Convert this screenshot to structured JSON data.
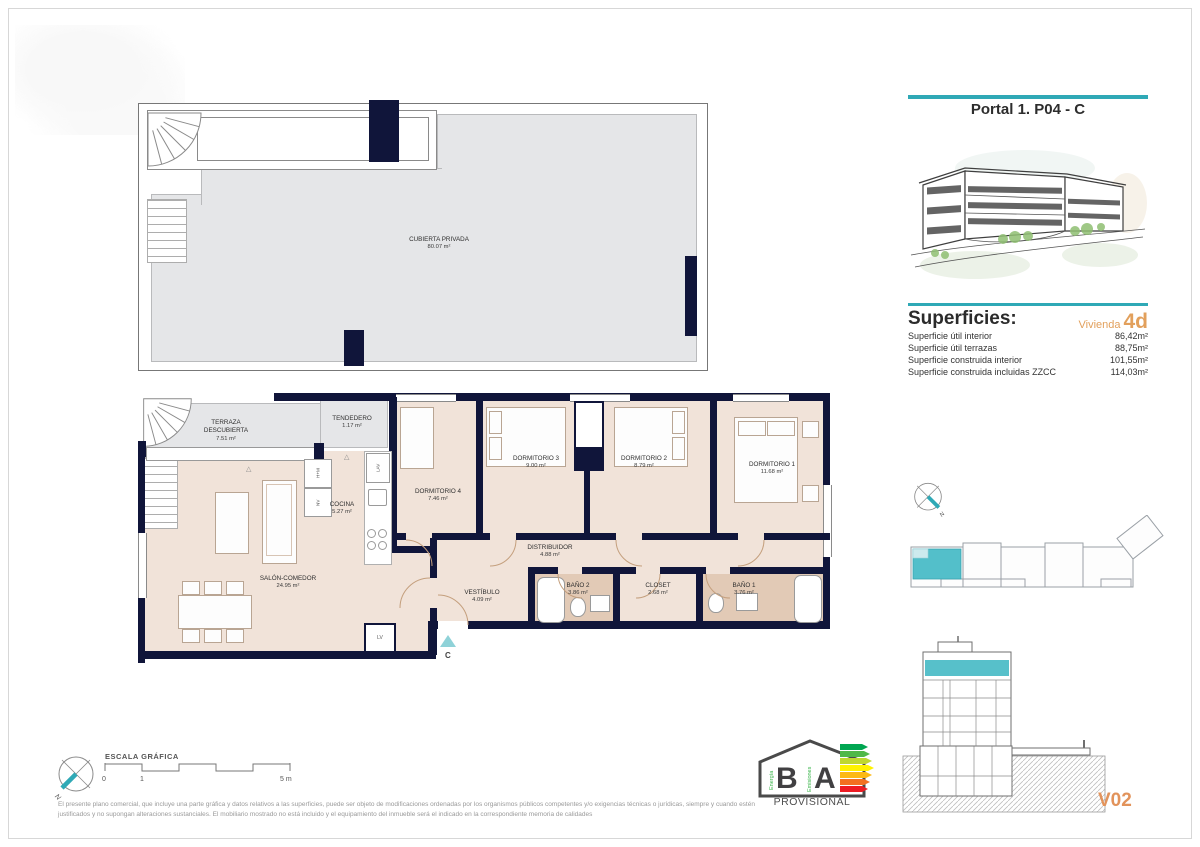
{
  "colors": {
    "teal_accent": "#2FA9B6",
    "teal_highlight": "#53BFCA",
    "orange_accent": "#E2A05C",
    "wall_navy": "#10153A",
    "floor_beige": "#F1E3D9",
    "bath_tan": "#E2CAB6",
    "terrace_gray": "#E5E6E8"
  },
  "header": {
    "title": "Portal 1. P04 - C"
  },
  "superficies": {
    "title": "Superficies:",
    "vivienda_label": "Vivienda",
    "vivienda_code": "4d",
    "rows": [
      {
        "label": "Superficie útil interior",
        "value": "86,42m²"
      },
      {
        "label": "Superficie útil terrazas",
        "value": "88,75m²"
      },
      {
        "label": "Superficie construida interior",
        "value": "101,55m²"
      },
      {
        "label": "Superficie construida incluidas ZZCC",
        "value": "114,03m²"
      }
    ]
  },
  "roof_plan": {
    "name": "CUBIERTA PRIVADA",
    "area": "80.07 m²"
  },
  "floor_plan": {
    "rooms": [
      {
        "name": "TERRAZA\nDESCUBIERTA",
        "area": "7.51 m²"
      },
      {
        "name": "TENDEDERO",
        "area": "1.17 m²"
      },
      {
        "name": "COCINA",
        "area": "5.27 m²"
      },
      {
        "name": "DORMITORIO 4",
        "area": "7.46 m²"
      },
      {
        "name": "DORMITORIO 3",
        "area": "9.00 m²"
      },
      {
        "name": "DORMITORIO 2",
        "area": "8.79 m²"
      },
      {
        "name": "DORMITORIO 1",
        "area": "11.68 m²"
      },
      {
        "name": "DISTRIBUIDOR",
        "area": "4.88 m²"
      },
      {
        "name": "VESTÍBULO",
        "area": "4.09 m²"
      },
      {
        "name": "BAÑO 2",
        "area": "3.86 m²"
      },
      {
        "name": "CLOSET",
        "area": "2.68 m²"
      },
      {
        "name": "BAÑO 1",
        "area": "3.76 m²"
      },
      {
        "name": "SALÓN-COMEDOR",
        "area": "24.95 m²"
      }
    ],
    "appliances": {
      "oven_micro": "H+M",
      "fridge": "NV",
      "washer": "LAV",
      "dishwasher": "LV"
    },
    "entrance_label": "C",
    "compass_label": "N"
  },
  "scale_bar": {
    "title": "ESCALA GRÁFICA",
    "tick_start": "0",
    "tick_mid": "1",
    "tick_end": "5 m"
  },
  "energy_label": {
    "letter_left": "B",
    "letter_right": "A",
    "vertical_left": "Energía",
    "vertical_right": "Emisiones",
    "caption": "PROVISIONAL"
  },
  "disclaimer": "El presente plano comercial, que incluye una parte gráfica y datos relativos a las superficies, puede ser objeto de modificaciones ordenadas por los organismos públicos competentes y/o exigencias técnicas o jurídicas, siempre y cuando estén justificados y no supongan alteraciones sustanciales. El mobiliario mostrado no está incluido y el equipamiento del inmueble será el indicado en la correspondiente memoria de calidades",
  "version": "V02"
}
